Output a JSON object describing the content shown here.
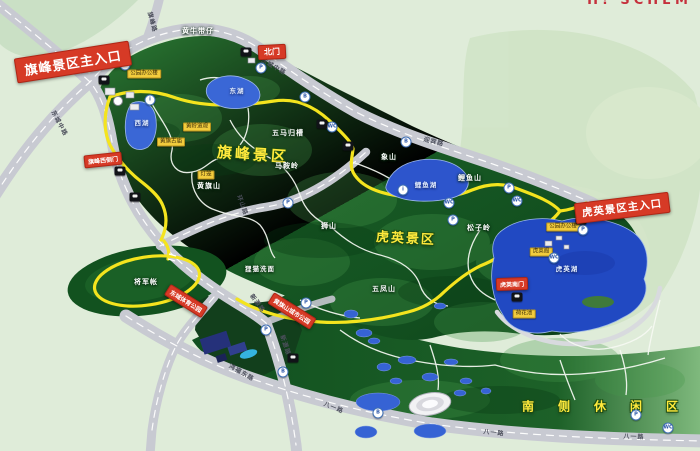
{
  "board_title_partial": "H! SCHEM",
  "gates": {
    "qifeng_main": "旗峰景区主入口",
    "north": "北门",
    "huying_main": "虎英景区主入口",
    "qifeng_west": "旗峰西侧门",
    "huying_south": "虎英南门"
  },
  "park_signs": {
    "huangqishan_park": "黄旗山城市公园",
    "dongcheng_sports_park": "东城体育公园"
  },
  "zones": {
    "qifeng": "旗峰景区",
    "huying": "虎英景区",
    "south_leisure": "南侧休闲区"
  },
  "peaks": {
    "huangniu": "黄牛带仔",
    "wuma": "五马归槽",
    "maan": "马鞍岭",
    "xiang": "象山",
    "liyushan": "鲤鱼山",
    "huangqishan": "黄旗山",
    "songziling": "松子岭",
    "shishan": "狮山",
    "wufengshan": "五凤山",
    "limaoximian": "狸猫洗面",
    "jiangjunzhang": "将军帐"
  },
  "lakes": {
    "east": "东湖",
    "west": "西湖",
    "liyu": "鲤鱼湖",
    "huying": "虎英湖"
  },
  "roads": {
    "dongchengzhong_1": "东城中路",
    "dongchengzhong_2": "东城中路",
    "qifeng_road": "旗峰路",
    "yingbin": "迎宾路",
    "huanshan": "环山路",
    "xinyuan_1": "新源路",
    "xinyuan_2": "新源路",
    "hongfudong": "鸿福东路",
    "bayi_1": "八一路",
    "bayi_2": "八一路",
    "bayi_3": "八一路"
  },
  "facilities": {
    "park_office_qifeng": "公园办公楼",
    "huangling_temple": "黄岭道观",
    "huangqi_temple": "黄旗古庙",
    "lantern": "灯笼",
    "park_office_huying": "公园办公楼",
    "huying_pavilion": "虎英阁",
    "lotus_pond": "荷花池"
  },
  "pois": [
    {
      "glyph": "P"
    },
    {
      "glyph": "P"
    },
    {
      "glyph": "B"
    },
    {
      "glyph": "WC"
    },
    {
      "glyph": "B"
    },
    {
      "glyph": "P"
    },
    {
      "glyph": "i"
    },
    {
      "glyph": "WC"
    },
    {
      "glyph": "P"
    },
    {
      "glyph": "WC"
    },
    {
      "glyph": "P"
    },
    {
      "glyph": "WC"
    },
    {
      "glyph": "P"
    },
    {
      "glyph": "P"
    },
    {
      "glyph": "B"
    },
    {
      "glyph": "B"
    },
    {
      "glyph": "P"
    },
    {
      "glyph": "WC"
    },
    {
      "glyph": "i"
    },
    {
      "glyph": "P"
    }
  ],
  "colors": {
    "background": "#dfecd9",
    "park_green": "#14521f",
    "road_grey": "#c8cad2",
    "greenway_yellow": "#f4e41e",
    "lake_blue": "#2149c2",
    "sign_red": "#d63a26",
    "zone_yellow": "#ffe93c"
  }
}
